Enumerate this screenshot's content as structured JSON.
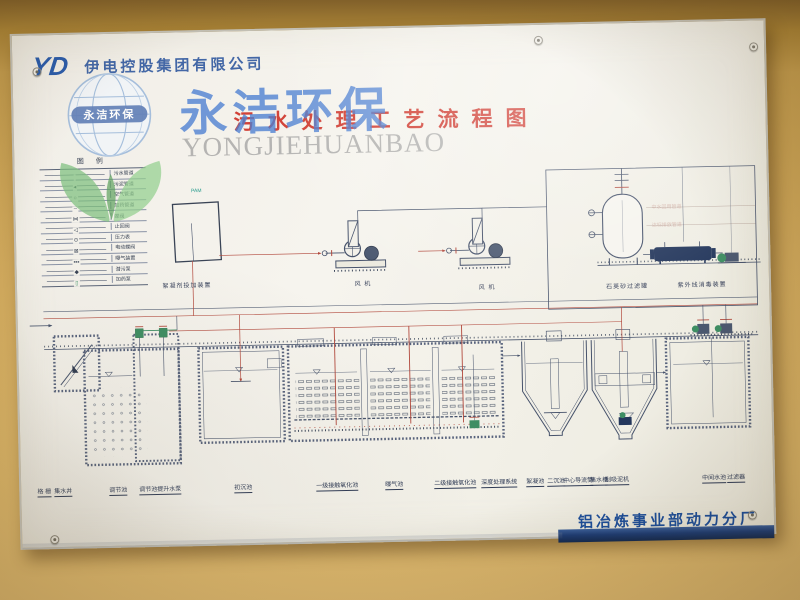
{
  "header": {
    "logo_text": "YD",
    "company_name": "伊电控股集团有限公司",
    "title": "污水处理工艺流程图"
  },
  "watermark": {
    "cn": "永洁环保",
    "en": "YONGJIEHUANBAO",
    "seal": "永洁环保"
  },
  "legend": {
    "title": "图 例",
    "items": [
      {
        "sym": "",
        "label": "污水管道"
      },
      {
        "sym": "◂",
        "label": "污泥管道"
      },
      {
        "sym": "○",
        "label": "空气管道"
      },
      {
        "sym": "┄",
        "label": "加药管道"
      },
      {
        "sym": "⋈",
        "label": "蝶阀"
      },
      {
        "sym": "◁",
        "label": "止回阀"
      },
      {
        "sym": "⊙",
        "label": "压力表"
      },
      {
        "sym": "⊠",
        "label": "电动蝶阀"
      },
      {
        "sym": "▪▪▪",
        "label": "曝气装置"
      },
      {
        "sym": "◆",
        "label": "潜污泵"
      },
      {
        "sym": "▯",
        "label": "加药泵"
      }
    ]
  },
  "equipment": {
    "dosing_label": "絮凝剂投加装置",
    "dosing_tag": "PAM",
    "blower1_label": "风 机",
    "blower2_label": "风 机",
    "filter_label": "石英砂过滤罐",
    "uv_label": "紫外线消毒装置",
    "pipe_note1": "中水回用管道",
    "pipe_note2": "达标排放管道"
  },
  "tanks": [
    "格 栅",
    "集水井",
    "调节池",
    "调节池提升水泵",
    "初沉池",
    "一级接触氧化池",
    "曝气池",
    "二级接触氧化池",
    "深度处理系统",
    "絮凝池",
    "二沉池",
    "中心导流筒",
    "集水槽",
    "刮吸泥机",
    "中间水池",
    "过滤器"
  ],
  "footer": {
    "plant_name": "铝冶炼事业部动力分厂"
  },
  "colors": {
    "wall": "#cfa85c",
    "board": "#f3f1ea",
    "company_blue": "#31599f",
    "title_red": "#cf3328",
    "watermark_blue": "#4d80d2",
    "diagram_line": "#46526b",
    "pipe_red": "#b2493d",
    "pump_green": "#3e8e63",
    "uv_navy": "#24375c",
    "footer_blue": "#1c4e9b"
  }
}
